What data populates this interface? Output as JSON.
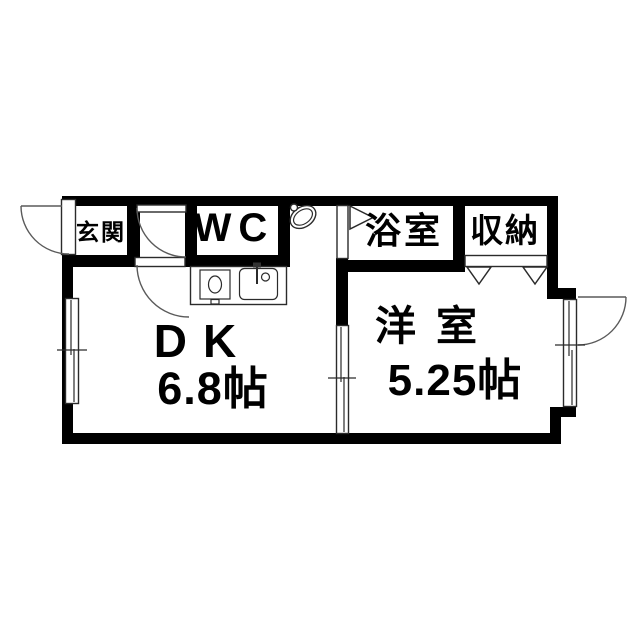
{
  "page": {
    "background_color": "#ffffff",
    "wall_color": "#000000",
    "line_color": "#2b2b2b"
  },
  "floorplan": {
    "kind": "japanese-apartment-floor-plan",
    "rooms": {
      "entrance": {
        "label": "玄関"
      },
      "wc": {
        "label": "WC"
      },
      "bathroom": {
        "label": "浴室"
      },
      "storage": {
        "label": "収納"
      },
      "dining_kitchen": {
        "label": "DK",
        "size": "6.8帖"
      },
      "western_room": {
        "label": "洋室",
        "size": "5.25帖"
      }
    },
    "fixtures": [
      "entrance-swing-door",
      "hall-swing-door",
      "dk-swing-door",
      "bathroom-folding-door",
      "storage-double-hinged-door",
      "exterior-swing-door",
      "sliding-window-left",
      "sliding-partition-window",
      "sliding-window-right",
      "washbasin",
      "kitchen-counter-with-stove-and-sink"
    ]
  }
}
